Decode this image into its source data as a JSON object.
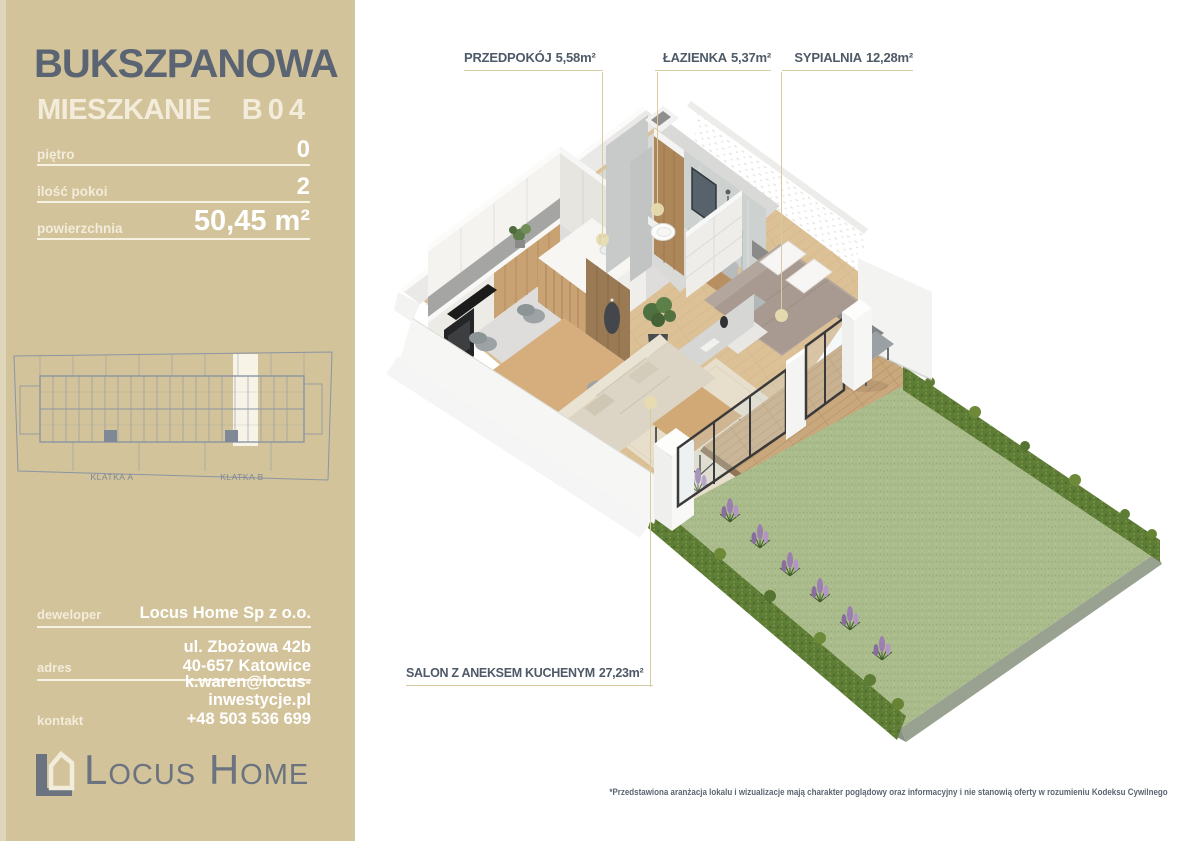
{
  "sidebar": {
    "title": "BUKSZPANOWA",
    "subtitle": "MIESZKANIE",
    "unit_code": "B04",
    "specs": [
      {
        "label": "piętro",
        "value": "0"
      },
      {
        "label": "ilość pokoi",
        "value": "2"
      },
      {
        "label": "powierzchnia",
        "value": "50,45 m²"
      }
    ],
    "diagram": {
      "stairwell_a": "KLATKA A",
      "stairwell_b": "KLATKA B"
    },
    "contacts": [
      {
        "label": "deweloper",
        "lines": [
          "Locus Home Sp z o.o."
        ]
      },
      {
        "label": "adres",
        "lines": [
          "ul. Zbożowa 42b",
          "40-657 Katowice"
        ]
      },
      {
        "label": "kontakt",
        "lines": [
          "k.waren@locus-inwestycje.pl",
          "+48 503 536 699"
        ]
      }
    ],
    "logo_text": "Locus Home"
  },
  "plan": {
    "labels": {
      "przedpokoj": {
        "name": "PRZEDPOKÓJ",
        "area": "5,58m²"
      },
      "lazienka": {
        "name": "ŁAZIENKA",
        "area": "5,37m²"
      },
      "sypialnia": {
        "name": "SYPIALNIA",
        "area": "12,28m²"
      },
      "salon": {
        "name": "SALON Z ANEKSEM KUCHENYM",
        "area": "27,23m²"
      }
    },
    "disclaimer": "*Przedstawiona aranżacja lokalu i wizualizacje mają charakter poglądowy oraz informacyjny i nie stanowią oferty w rozumieniu Kodeksu Cywilnego"
  },
  "colors": {
    "sidebar_bg": "#d2c39a",
    "title_slate": "#5b6472",
    "ivory": "#f3ecda",
    "label_text": "#4e5a67",
    "leader_line": "#d8cba2",
    "diagram_line": "#8b95a3",
    "logo_gray": "#6b7380",
    "lawn_green": "#aabc8c",
    "hedge_green": "#5d7c35",
    "flower_purple": "#9b7fae",
    "wood_floor": "#dcc096"
  }
}
